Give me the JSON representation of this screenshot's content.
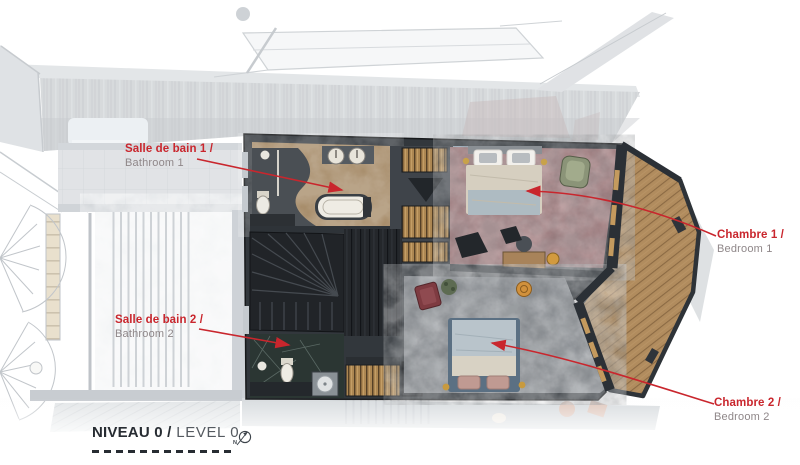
{
  "callouts": {
    "bathroom1": {
      "title": "Salle de bain 1 /",
      "subtitle": "Bathroom 1"
    },
    "bathroom2": {
      "title": "Salle de bain 2 /",
      "subtitle": "Bathroom 2"
    },
    "bedroom1": {
      "title": "Chambre 1 /",
      "subtitle": "Bedroom 1"
    },
    "bedroom2": {
      "title": "Chambre 2 /",
      "subtitle": "Bedroom 2"
    }
  },
  "footer": {
    "title_fr": "NIVEAU 0 /",
    "title_en": " LEVEL 0",
    "compass_letter": "N"
  },
  "colors": {
    "annotation_red": "#c9262d",
    "subtitle_gray": "#8f8789",
    "footer_dark": "#272c32",
    "footer_gray": "#555a60"
  }
}
